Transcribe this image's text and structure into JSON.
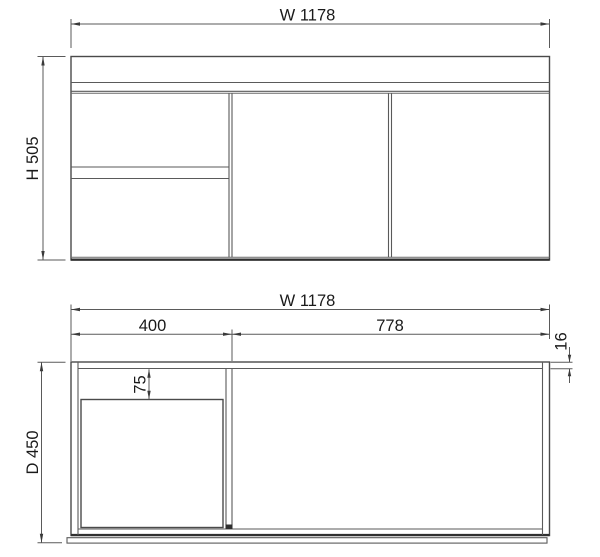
{
  "figure": {
    "type": "technical-drawing",
    "subject": "vanity-cabinet",
    "front_view": {
      "width_dim": "W 1178",
      "height_dim": "H 505"
    },
    "plan_view": {
      "width_dim": "W 1178",
      "left_section_dim": "400",
      "right_section_dim": "778",
      "panel_thickness_dim": "16",
      "sink_offset_dim": "75",
      "depth_dim": "D 450"
    },
    "colors": {
      "line": "#4a4a4a",
      "dark_line": "#2f2f2f",
      "text": "#1a1a1a",
      "background": "#ffffff"
    }
  }
}
